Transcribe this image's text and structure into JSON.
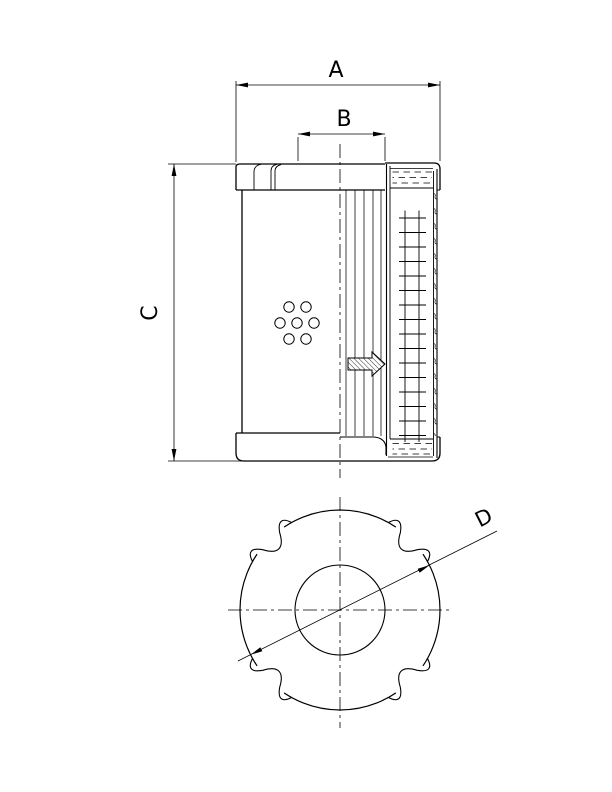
{
  "drawing": {
    "title": "filter-element-dimensional-drawing",
    "colors": {
      "line": "#000000",
      "background": "#ffffff"
    },
    "labels": {
      "dim_a": "A",
      "dim_b": "B",
      "dim_c": "C",
      "dim_d": "D"
    }
  }
}
